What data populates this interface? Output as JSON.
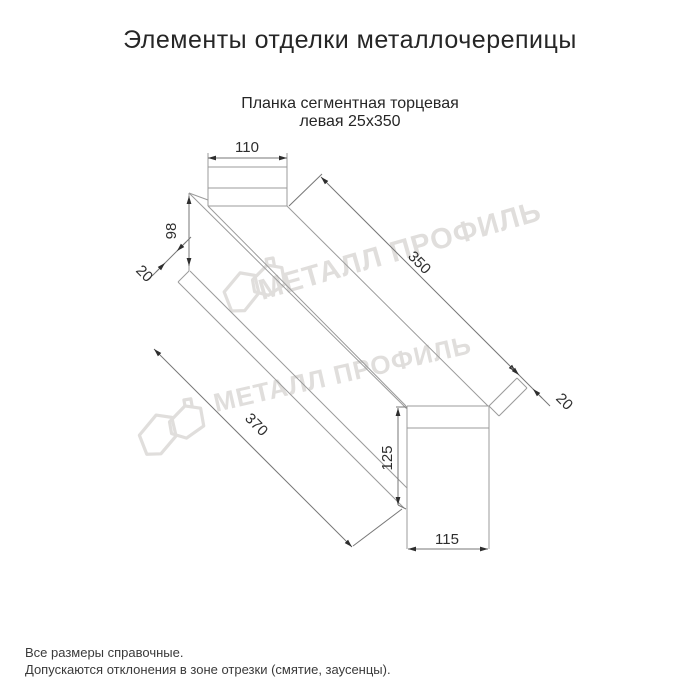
{
  "title": "Элементы отделки металлочерепицы",
  "subtitle": {
    "line1": "Планка сегментная торцевая",
    "line2": "левая 25х350"
  },
  "drawing": {
    "part_name": "planka-segmentnaya-tortsevaya-levaya-25x350",
    "dimensions": {
      "top_width": "110",
      "left_height": "98",
      "left_flange": "20",
      "length_top": "350",
      "length_bottom": "370",
      "right_flange": "20",
      "right_height": "125",
      "bottom_width": "115"
    },
    "line_color": "#9b9b9b",
    "dim_color": "#2e2e2e"
  },
  "watermark": {
    "text": "МЕТАЛЛ ПРОФИЛЬ",
    "color": "#e0dedc"
  },
  "footer": {
    "line1": "Все размеры справочные.",
    "line2": "Допускаются отклонения в зоне отрезки (смятие, заусенцы)."
  }
}
